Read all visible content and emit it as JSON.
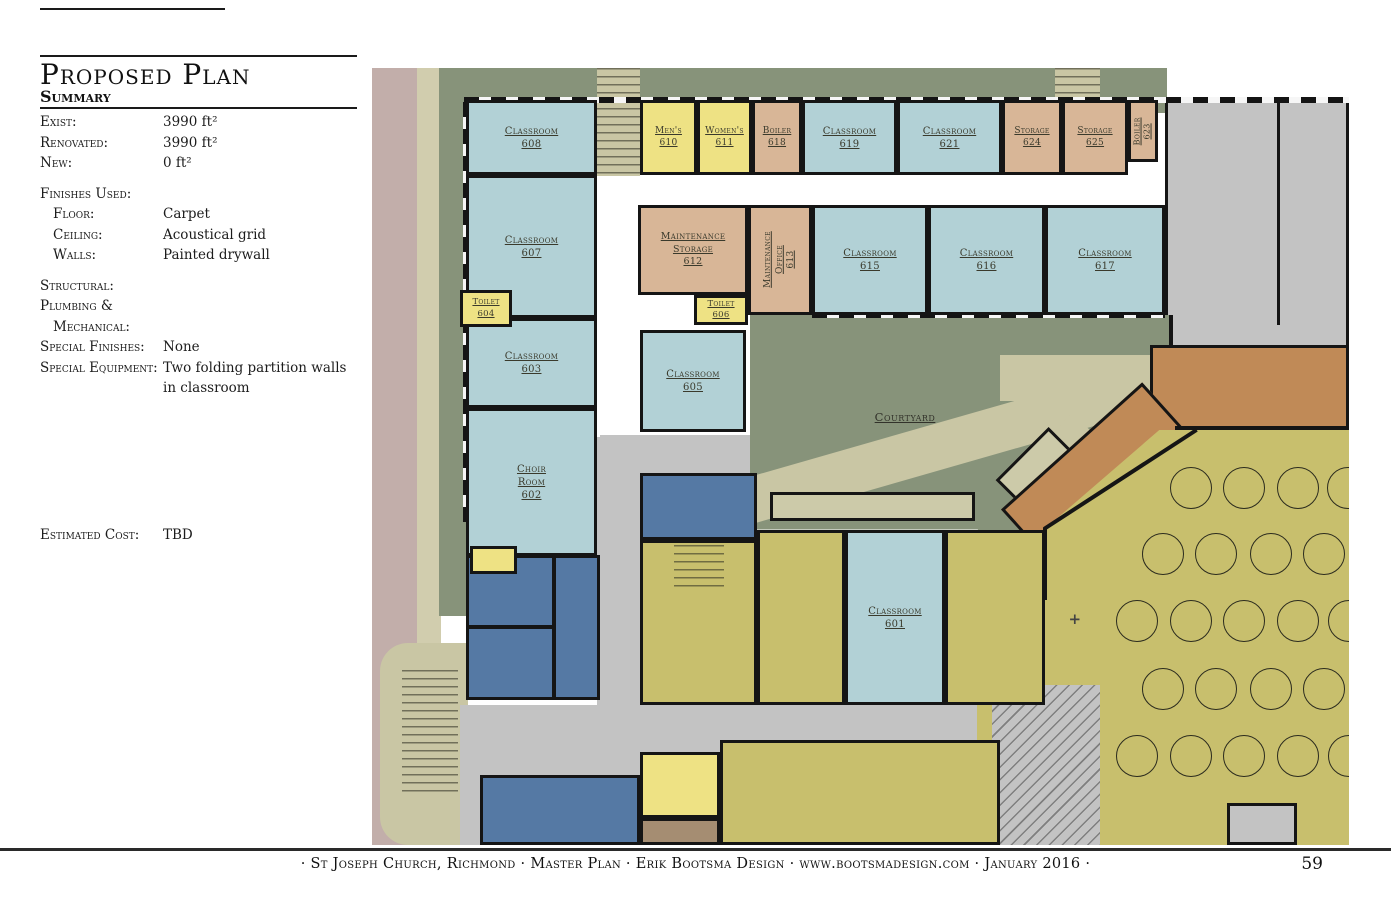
{
  "header": {
    "title": "Proposed Plan",
    "subtitle": "Summary"
  },
  "summary": {
    "rows": [
      {
        "label": "Exist:",
        "value": "3990 ft²"
      },
      {
        "label": "Renovated:",
        "value": "3990 ft²"
      },
      {
        "label": "New:",
        "value": "0 ft²"
      },
      {
        "label": "Finishes Used:",
        "value": "",
        "gap": true
      },
      {
        "label": "Floor:",
        "value": "Carpet",
        "indent": true
      },
      {
        "label": "Ceiling:",
        "value": "Acoustical grid",
        "indent": true
      },
      {
        "label": "Walls:",
        "value": "Painted drywall",
        "indent": true
      },
      {
        "label": "Structural:",
        "value": "",
        "gap": true
      },
      {
        "label": "Plumbing &",
        "value": ""
      },
      {
        "label": "Mechanical:",
        "value": "",
        "indent": true
      },
      {
        "label": "Special Finishes:",
        "value": "None"
      },
      {
        "label": "Special Equipment:",
        "value": "Two folding partition walls in classroom"
      },
      {
        "label": "Estimated Cost:",
        "value": "TBD",
        "biggap": true
      }
    ]
  },
  "footer": {
    "text": "· St Joseph Church, Richmond · Master Plan · Erik Bootsma Design · www.bootsmadesign.com · January 2016 ·",
    "page": "59"
  },
  "colors": {
    "blue": "#b2d1d6",
    "yellow": "#eee284",
    "tan": "#d8b697",
    "darkblue": "#5579a4",
    "olive": "#c8bf6d",
    "green": "#87937a",
    "path": "#c9c6a4",
    "path2": "#cccaa9",
    "khaki": "#d1cdae",
    "mauve": "#c2aeaa",
    "gray": "#c3c3c3",
    "orange": "#c08a57",
    "brown": "#a58d72",
    "wall": "#151515"
  },
  "plan": {
    "zones": [
      {
        "n": "street-left",
        "c": "mauve",
        "x": 0,
        "y": 0,
        "w": 47,
        "h": 777
      },
      {
        "n": "sidewalk-left",
        "c": "khaki",
        "x": 45,
        "y": 0,
        "w": 24,
        "h": 777
      },
      {
        "n": "lawn-left",
        "c": "green",
        "x": 67,
        "y": 0,
        "w": 28,
        "h": 548
      },
      {
        "n": "lawn-top",
        "c": "green",
        "x": 67,
        "y": 0,
        "w": 728,
        "h": 45
      },
      {
        "n": "entry-stairs-top",
        "c": "path",
        "x": 225,
        "y": 0,
        "w": 43,
        "h": 108,
        "k": "pat-steps"
      },
      {
        "n": "entry-top-center",
        "c": "path",
        "x": 683,
        "y": 0,
        "w": 45,
        "h": 42,
        "k": "pat-steps"
      },
      {
        "n": "porch-bottom-left",
        "c": "path",
        "x": 8,
        "y": 575,
        "w": 88,
        "h": 202,
        "k": "round-l"
      },
      {
        "n": "porch-steps",
        "x": 30,
        "y": 602,
        "w": 56,
        "h": 128,
        "k": "pat-steps"
      },
      {
        "n": "corridor-right-top",
        "c": "gray",
        "x": 793,
        "y": 32,
        "w": 184,
        "h": 280,
        "b": 1
      },
      {
        "n": "wall-corridor-right-divider",
        "c": "wall",
        "x": 905,
        "y": 32,
        "w": 3,
        "h": 225
      },
      {
        "n": "corridor-mid",
        "c": "gray",
        "x": 228,
        "y": 367,
        "w": 190,
        "h": 40
      },
      {
        "n": "corridor-vert",
        "c": "gray",
        "x": 225,
        "y": 369,
        "w": 43,
        "h": 270
      },
      {
        "n": "corridor-bottom",
        "c": "gray",
        "x": 88,
        "y": 637,
        "w": 612,
        "h": 140
      },
      {
        "n": "corridor-gap-vert",
        "c": "gray",
        "x": 228,
        "y": 472,
        "w": 40,
        "h": 165
      },
      {
        "n": "courtyard",
        "c": "green",
        "x": 378,
        "y": 247,
        "w": 422,
        "h": 275,
        "k": "ovh",
        "clip": "polygon(0 0,100% 0,100% 55%,66% 100%,54% 100%,54% 78%,0 78%)"
      },
      {
        "n": "courtyard-path-main",
        "c": "path",
        "x": -30,
        "y": 91,
        "w": 560,
        "h": 46,
        "rot": -16,
        "in": "courtyard"
      },
      {
        "n": "courtyard-path-branch",
        "c": "path",
        "x": 290,
        "y": 140,
        "w": 140,
        "h": 40,
        "rot": 42,
        "in": "courtyard"
      },
      {
        "n": "courtyard-path-top",
        "c": "path",
        "x": 250,
        "y": 40,
        "w": 180,
        "h": 46,
        "in": "courtyard"
      },
      {
        "n": "courtyard-plaza",
        "c": "path2",
        "x": 20,
        "y": 177,
        "w": 205,
        "h": 29,
        "b": 1,
        "in": "courtyard"
      },
      {
        "n": "courtyard-bench",
        "c": "path2",
        "x": 248,
        "y": 133,
        "w": 75,
        "h": 38,
        "rot": -45,
        "b": 1,
        "in": "courtyard"
      },
      {
        "n": "wall-courtyard-right",
        "c": "wall",
        "x": 797,
        "y": 247,
        "w": 4,
        "h": 116
      },
      {
        "n": "narthex",
        "c": "orange",
        "x": 778,
        "y": 277,
        "w": 199,
        "h": 86,
        "b": 1
      },
      {
        "n": "narthex-arm",
        "c": "orange",
        "x": 633,
        "y": 367,
        "w": 190,
        "h": 85,
        "rot": -42,
        "b": 1
      },
      {
        "n": "hall",
        "c": "olive",
        "x": 605,
        "y": 362,
        "w": 372,
        "h": 415,
        "clip": "polygon(0 100%,0 63%,18% 48%,18% 24%,49% 0,100% 0,100% 100%)"
      },
      {
        "n": "hall-wall-top",
        "c": "wall",
        "x": 803,
        "y": 358,
        "w": 174,
        "h": 4
      },
      {
        "n": "hall-wall-diag",
        "c": "wall",
        "x": 672,
        "y": 459,
        "w": 182,
        "h": 4,
        "rot": -33,
        "orig": 1
      },
      {
        "n": "hall-wall-left",
        "c": "wall",
        "x": 671,
        "y": 460,
        "w": 4,
        "h": 72
      },
      {
        "n": "hall-stairs",
        "c": "gray",
        "x": 620,
        "y": 617,
        "w": 108,
        "h": 160,
        "k": "pat-diag"
      },
      {
        "n": "hall-entry",
        "c": "gray",
        "x": 855,
        "y": 735,
        "w": 70,
        "h": 42,
        "b": 1
      },
      {
        "n": "office-below-605",
        "c": "darkblue",
        "x": 268,
        "y": 405,
        "w": 117,
        "h": 67,
        "b": 1
      },
      {
        "n": "office-block-a",
        "c": "darkblue",
        "x": 94,
        "y": 487,
        "w": 89,
        "h": 73,
        "b": 1
      },
      {
        "n": "office-block-b",
        "c": "darkblue",
        "x": 94,
        "y": 558,
        "w": 89,
        "h": 74,
        "b": 1
      },
      {
        "n": "office-block-c",
        "c": "darkblue",
        "x": 181,
        "y": 487,
        "w": 47,
        "h": 145,
        "b": 1
      },
      {
        "n": "restroom-block",
        "c": "olive",
        "x": 268,
        "y": 472,
        "w": 117,
        "h": 165,
        "b": 1
      },
      {
        "n": "restroom-stairs",
        "x": 302,
        "y": 477,
        "w": 50,
        "h": 46,
        "k": "pat-steps"
      },
      {
        "n": "room-olive-left-601",
        "c": "olive",
        "x": 385,
        "y": 462,
        "w": 88,
        "h": 175,
        "b": 1
      },
      {
        "n": "restrooms-right-601",
        "c": "olive",
        "x": 573,
        "y": 462,
        "w": 100,
        "h": 175,
        "b": 1
      },
      {
        "n": "room-blue-bottom",
        "c": "darkblue",
        "x": 108,
        "y": 707,
        "w": 160,
        "h": 70,
        "b": 1
      },
      {
        "n": "room-yellow-bottom",
        "c": "yellow",
        "x": 268,
        "y": 684,
        "w": 80,
        "h": 66,
        "b": 1
      },
      {
        "n": "room-brown-bottom",
        "c": "brown",
        "x": 268,
        "y": 750,
        "w": 80,
        "h": 27,
        "b": 1
      },
      {
        "n": "room-olive-bottom",
        "c": "olive",
        "x": 348,
        "y": 672,
        "w": 280,
        "h": 105,
        "b": 1
      },
      {
        "n": "windows-top",
        "x": 92,
        "y": 29,
        "w": 885,
        "h": 6,
        "k": "pat-win-h"
      },
      {
        "n": "windows-left",
        "x": 91,
        "y": 34,
        "w": 6,
        "h": 420,
        "k": "pat-win-v"
      },
      {
        "n": "windows-mid",
        "x": 440,
        "y": 244,
        "w": 353,
        "h": 6,
        "k": "pat-win-h"
      }
    ],
    "rooms": [
      {
        "n": "classroom-608",
        "t": [
          "Classroom"
        ],
        "num": "608",
        "x": 94,
        "y": 32,
        "w": 131,
        "h": 75,
        "c": "blue"
      },
      {
        "n": "mens-610",
        "t": [
          "Men's"
        ],
        "num": "610",
        "x": 268,
        "y": 32,
        "w": 57,
        "h": 75,
        "c": "yellow",
        "fs": 9
      },
      {
        "n": "womens-611",
        "t": [
          "Women's"
        ],
        "num": "611",
        "x": 325,
        "y": 32,
        "w": 55,
        "h": 75,
        "c": "yellow",
        "fs": 9
      },
      {
        "n": "boiler-618",
        "t": [
          "Boiler"
        ],
        "num": "618",
        "x": 380,
        "y": 32,
        "w": 50,
        "h": 75,
        "c": "tan",
        "fs": 9
      },
      {
        "n": "classroom-619",
        "t": [
          "Classroom"
        ],
        "num": "619",
        "x": 430,
        "y": 32,
        "w": 95,
        "h": 75,
        "c": "blue"
      },
      {
        "n": "classroom-621",
        "t": [
          "Classroom"
        ],
        "num": "621",
        "x": 525,
        "y": 32,
        "w": 105,
        "h": 75,
        "c": "blue"
      },
      {
        "n": "storage-624",
        "t": [
          "Storage"
        ],
        "num": "624",
        "x": 630,
        "y": 32,
        "w": 60,
        "h": 75,
        "c": "tan",
        "fs": 9
      },
      {
        "n": "storage-625",
        "t": [
          "Storage"
        ],
        "num": "625",
        "x": 690,
        "y": 32,
        "w": 66,
        "h": 75,
        "c": "tan",
        "fs": 9
      },
      {
        "n": "boiler-623",
        "t": [
          "Boiler"
        ],
        "num": "623",
        "x": 756,
        "y": 32,
        "w": 30,
        "h": 62,
        "c": "tan",
        "fs": 8,
        "v": 1
      },
      {
        "n": "classroom-607",
        "t": [
          "Classroom"
        ],
        "num": "607",
        "x": 94,
        "y": 107,
        "w": 131,
        "h": 143,
        "c": "blue"
      },
      {
        "n": "maintenance-storage-612",
        "t": [
          "Maintenance",
          "Storage"
        ],
        "num": "612",
        "x": 266,
        "y": 137,
        "w": 110,
        "h": 90,
        "c": "tan",
        "fs": 9.5
      },
      {
        "n": "maintenance-office-613",
        "t": [
          "Maintenance",
          "Office"
        ],
        "num": "613",
        "x": 376,
        "y": 137,
        "w": 64,
        "h": 110,
        "c": "tan",
        "fs": 9,
        "v": 1
      },
      {
        "n": "classroom-615",
        "t": [
          "Classroom"
        ],
        "num": "615",
        "x": 440,
        "y": 137,
        "w": 116,
        "h": 110,
        "c": "blue"
      },
      {
        "n": "classroom-616",
        "t": [
          "Classroom"
        ],
        "num": "616",
        "x": 556,
        "y": 137,
        "w": 117,
        "h": 110,
        "c": "blue"
      },
      {
        "n": "classroom-617",
        "t": [
          "Classroom"
        ],
        "num": "617",
        "x": 673,
        "y": 137,
        "w": 120,
        "h": 110,
        "c": "blue"
      },
      {
        "n": "toilet-606",
        "t": [
          "Toilet"
        ],
        "num": "606",
        "x": 322,
        "y": 227,
        "w": 54,
        "h": 30,
        "c": "yellow",
        "fs": 8.5
      },
      {
        "n": "classroom-603",
        "t": [
          "Classroom"
        ],
        "num": "603",
        "x": 94,
        "y": 250,
        "w": 131,
        "h": 90,
        "c": "blue"
      },
      {
        "n": "toilet-604",
        "t": [
          "Toilet"
        ],
        "num": "604",
        "x": 88,
        "y": 222,
        "w": 52,
        "h": 37,
        "c": "yellow",
        "fs": 8.5
      },
      {
        "n": "classroom-605",
        "t": [
          "Classroom"
        ],
        "num": "605",
        "x": 268,
        "y": 262,
        "w": 106,
        "h": 102,
        "c": "blue"
      },
      {
        "n": "choir-room-602",
        "t": [
          "Choir",
          "Room"
        ],
        "num": "602",
        "x": 94,
        "y": 340,
        "w": 131,
        "h": 148,
        "c": "blue"
      },
      {
        "n": "room-yellow-small",
        "t": [],
        "x": 98,
        "y": 478,
        "w": 47,
        "h": 28,
        "c": "yellow"
      },
      {
        "n": "classroom-601",
        "t": [
          "Classroom"
        ],
        "num": "601",
        "x": 473,
        "y": 462,
        "w": 100,
        "h": 175,
        "c": "blue"
      }
    ],
    "tables": {
      "r": 20,
      "rows": [
        {
          "y": 419,
          "xs": [
            818,
            871,
            925,
            975
          ]
        },
        {
          "y": 485,
          "xs": [
            790,
            843,
            898,
            951
          ]
        },
        {
          "y": 552,
          "xs": [
            764,
            818,
            871,
            925,
            976
          ]
        },
        {
          "y": 620,
          "xs": [
            790,
            843,
            898,
            951
          ]
        },
        {
          "y": 687,
          "xs": [
            764,
            818,
            871,
            925,
            976
          ]
        }
      ]
    },
    "labels": [
      {
        "t": "Courtyard",
        "x": 533,
        "y": 349,
        "fs": 11.5,
        "name": "courtyard-label"
      },
      {
        "t": "+",
        "x": 703,
        "y": 551,
        "fs": 15,
        "cls": "cross",
        "name": "cross-marker"
      }
    ]
  }
}
